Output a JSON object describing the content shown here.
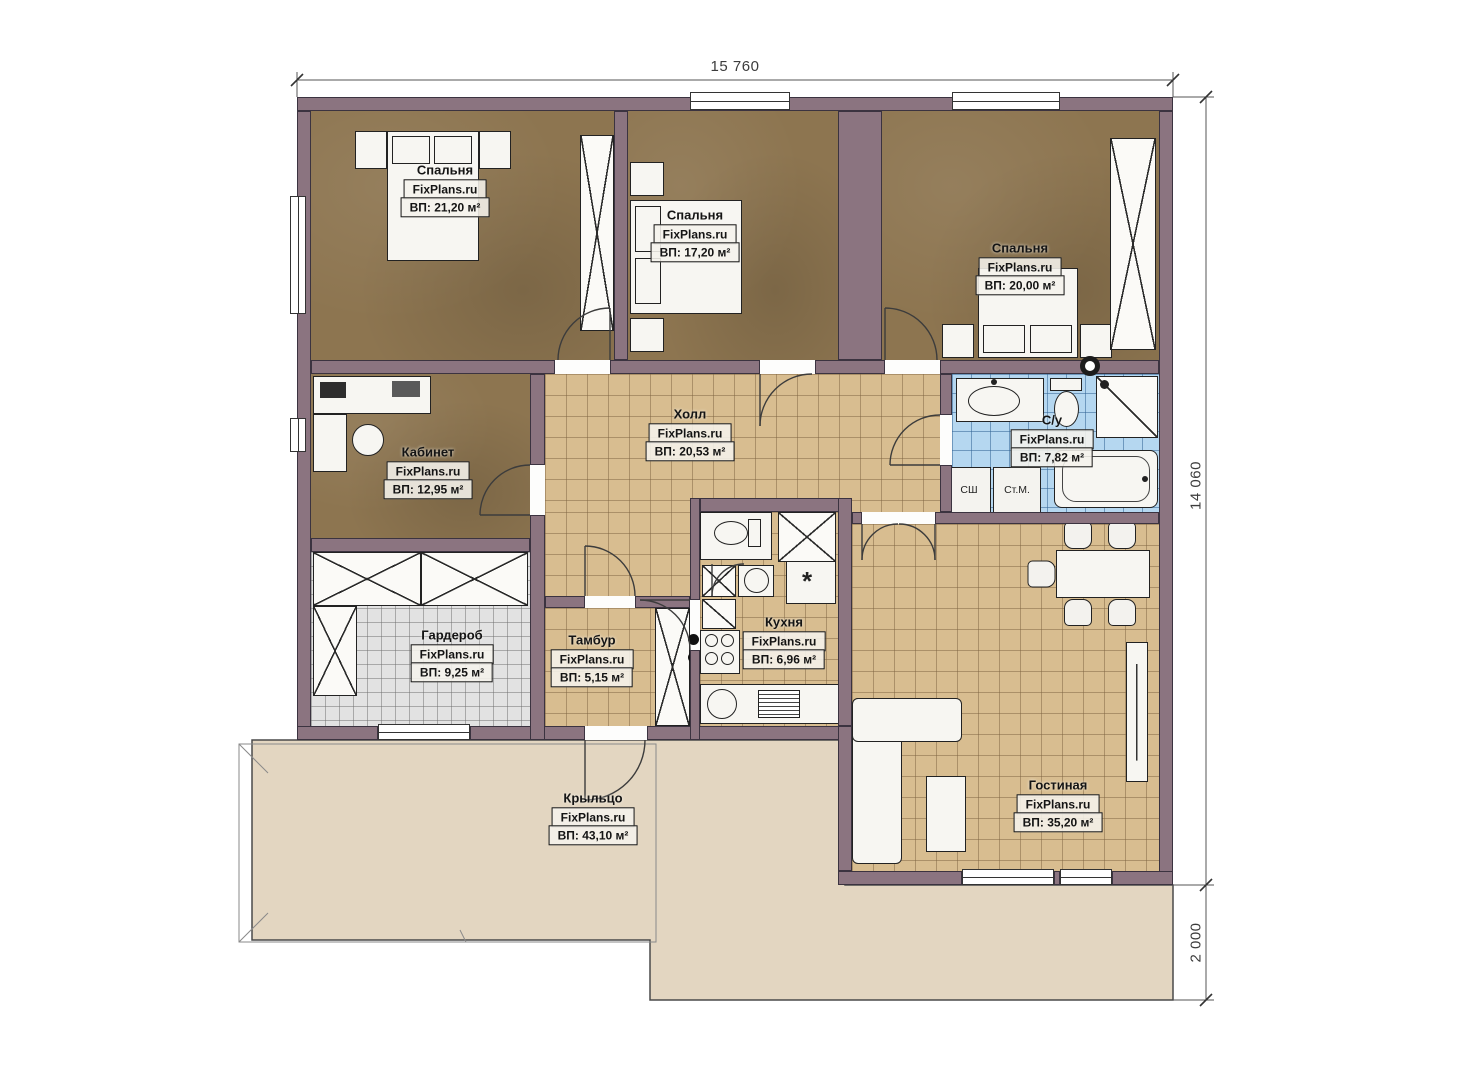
{
  "dimensions": {
    "width": "15 760",
    "depth": "14 060",
    "porch_depth": "2 000"
  },
  "rooms": [
    {
      "id": "bedroom-1",
      "name": "Спальня",
      "brand": "FixPlans.ru",
      "area": "ВП: 21,20 м²"
    },
    {
      "id": "bedroom-2",
      "name": "Спальня",
      "brand": "FixPlans.ru",
      "area": "ВП: 17,20 м²"
    },
    {
      "id": "bedroom-3",
      "name": "Спальня",
      "brand": "FixPlans.ru",
      "area": "ВП: 20,00 м²"
    },
    {
      "id": "office",
      "name": "Кабинет",
      "brand": "FixPlans.ru",
      "area": "ВП: 12,95 м²"
    },
    {
      "id": "hall",
      "name": "Холл",
      "brand": "FixPlans.ru",
      "area": "ВП: 20,53 м²"
    },
    {
      "id": "bathroom",
      "name": "С/у",
      "brand": "FixPlans.ru",
      "area": "ВП: 7,82 м²"
    },
    {
      "id": "wardrobe",
      "name": "Гардероб",
      "brand": "FixPlans.ru",
      "area": "ВП: 9,25 м²"
    },
    {
      "id": "vestibule",
      "name": "Тамбур",
      "brand": "FixPlans.ru",
      "area": "ВП: 5,15 м²"
    },
    {
      "id": "kitchen",
      "name": "Кухня",
      "brand": "FixPlans.ru",
      "area": "ВП: 6,96 м²"
    },
    {
      "id": "living",
      "name": "Гостиная",
      "brand": "FixPlans.ru",
      "area": "ВП: 35,20 м²"
    },
    {
      "id": "porch",
      "name": "Крыльцо",
      "brand": "FixPlans.ru",
      "area": "ВП: 43,10 м²"
    }
  ],
  "appliance_labels": {
    "dryer": "СШ",
    "washing_machine": "Ст.М."
  },
  "symbols": {
    "fridge": "*"
  },
  "colors": {
    "wall": "#8b7480",
    "bedroom_floor": "#8d7550",
    "tile_tan": "#d8bd90",
    "tile_blue": "#b5d7f0",
    "tile_gray": "#e2e2e2",
    "porch": "#e3d6c1"
  }
}
